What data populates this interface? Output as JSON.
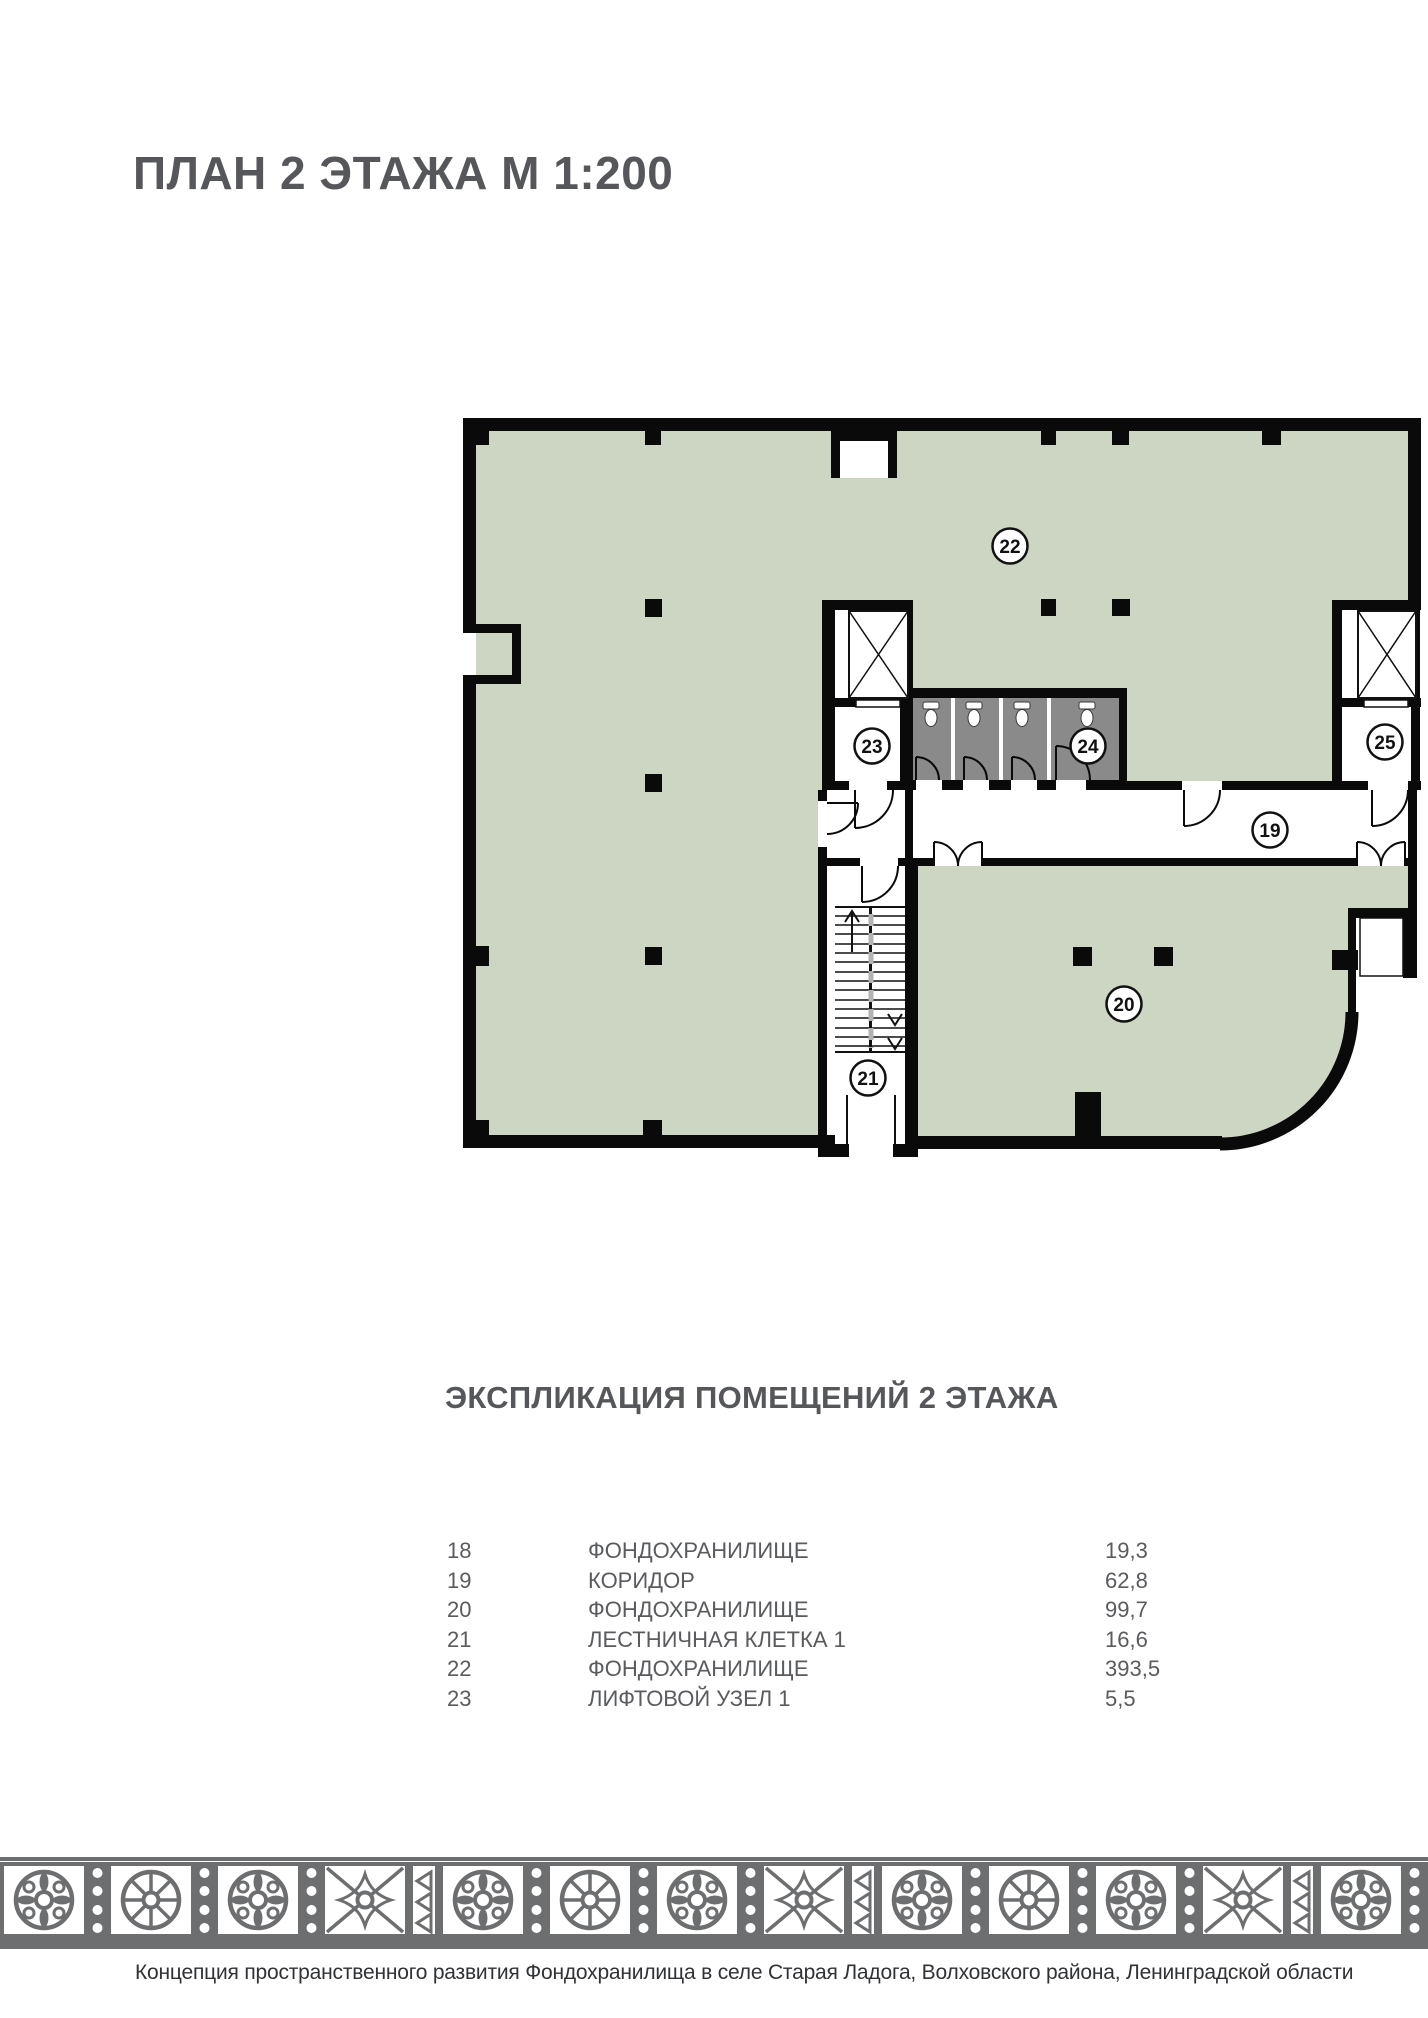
{
  "page": {
    "title": "ПЛАН 2 ЭТАЖА М 1:200"
  },
  "plan": {
    "labels": {
      "l19": "19",
      "l20": "20",
      "l21": "21",
      "l22": "22",
      "l23": "23",
      "l24": "24",
      "l25": "25"
    }
  },
  "explication": {
    "title": "ЭКСПЛИКАЦИЯ ПОМЕЩЕНИЙ 2 ЭТАЖА",
    "rows": [
      {
        "num": "18",
        "name": "ФОНДОХРАНИЛИЩЕ",
        "area": "19,3"
      },
      {
        "num": "19",
        "name": "КОРИДОР",
        "area": "62,8"
      },
      {
        "num": "20",
        "name": "ФОНДОХРАНИЛИЩЕ",
        "area": "99,7"
      },
      {
        "num": "21",
        "name": "ЛЕСТНИЧНАЯ КЛЕТКА 1",
        "area": "16,6"
      },
      {
        "num": "22",
        "name": "ФОНДОХРАНИЛИЩЕ",
        "area": "393,5"
      },
      {
        "num": "23",
        "name": "ЛИФТОВОЙ УЗЕЛ 1",
        "area": "5,5"
      }
    ]
  },
  "footer": {
    "caption": "Концепция пространственного развития Фондохранилища в селе Старая Ладога, Волховского района, Ленинградской области"
  },
  "palette": {
    "room_fill": "#CCD6C2",
    "wall": "#0A0A0A",
    "sanitary_fill": "#8A8A8A",
    "ornament": "#6D6E70",
    "heading_text": "#55575A",
    "table_text": "#595B5E",
    "footer_text": "#303235"
  }
}
